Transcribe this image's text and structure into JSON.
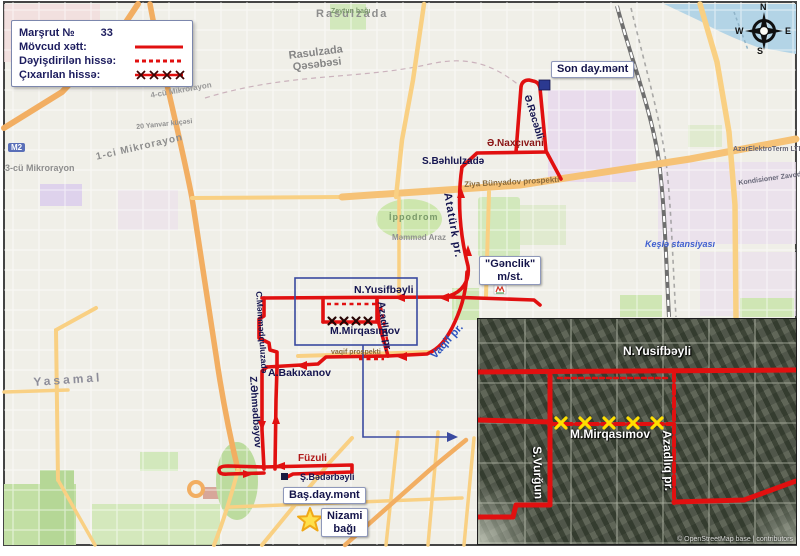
{
  "legend": {
    "route_label": "Marşrut №",
    "route_number": "33",
    "existing": "Mövcud xətt:",
    "changed": "Dəyişdirilən hissə:",
    "removed": "Çıxarılan hissə:"
  },
  "compass": {
    "n": "N",
    "e": "E",
    "s": "S",
    "w": "W"
  },
  "labels": {
    "end_terminal": "Son day.mənt",
    "start_terminal": "Baş.day.mənt",
    "genclik_line1": "\"Gənclik\"",
    "genclik_line2": "m/st.",
    "nizami_line1": "Nizami",
    "nizami_line2": "bağı"
  },
  "streets": {
    "naxcivani": "Ə.Naxçıvani",
    "rajabli": "Ə.Rəcəbli",
    "bahlulzade": "S.Bəhlulzadə",
    "ataturk": "Atatürk pr.",
    "yusifbeyli": "N.Yusifbəyli",
    "mirqasimov": "M.Mirqasımov",
    "azadliq": "Azadlıq pr.",
    "vaqif": "Vaqif pr.",
    "bakixanov": "A.Bakıxanov",
    "mammadquluzada": "C.Məmmədquluzadə",
    "ahmadbeyov": "Z.Əhmədbəyov",
    "fuzuli": "Füzuli",
    "badarbeyli": "Ş.Bədərbəyli"
  },
  "areas": {
    "rasulzada": "Rasulzada",
    "qasabasi_line1": "Rasulzada",
    "qasabasi_line2": "Qəsəbəsi",
    "mikrorayon1": "1-ci Mikrorayon",
    "mikrorayon3": "3-cü Mikrorayon",
    "mikrorayon4": "4-cü Mikrorayon",
    "yasamal": "Yasamal",
    "ippodrom": "İppodrom",
    "kesle": "Keşlə stansiyası",
    "ziya": "Ziya Bünyadov prospekti",
    "vaqif_prospekti": "vaqif prospekti",
    "mammad_araz": "Məmməd Araz",
    "zeytun": "Zeytun bağı",
    "m2": "M2",
    "elektroterm": "AzərElektroTerm LTD",
    "kondisioner": "Kondisioner Zavodu",
    "yanvar20": "20 Yanvar küçəsi"
  },
  "inset": {
    "yusifbeyli": "N.Yusifbəyli",
    "mirqasimov": "M.Mirqasımov",
    "vurgun": "S.Vurğun",
    "azadliq": "Azadlıq pr.",
    "copyright": "© OpenStreetMap base | contributors"
  },
  "colors": {
    "route_red": "#e11010",
    "removed_x_map": "#260303",
    "removed_x_inset": "#ffdf00",
    "indicator_blue": "#3a4aa0",
    "water": "#b3d4e6",
    "terminal_blue": "#2b3990",
    "star_yellow": "#ffe04a"
  }
}
